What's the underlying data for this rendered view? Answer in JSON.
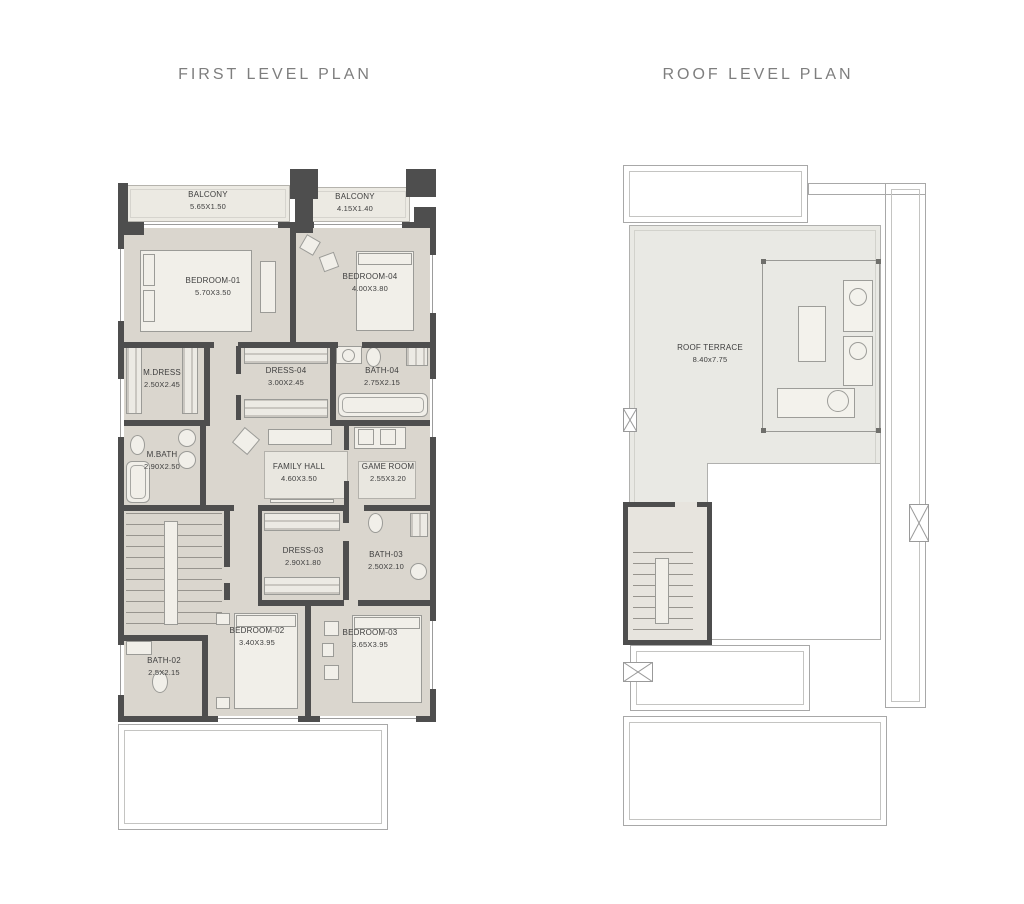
{
  "titles": {
    "first": "FIRST LEVEL PLAN",
    "roof": "ROOF LEVEL PLAN"
  },
  "colors": {
    "wall": "#4e4e4e",
    "floor": "#dad6ce",
    "balcony_floor": "#eceae3",
    "terrace": "#e9e9e4",
    "outline": "#a8a8a8",
    "title_text": "#7e7e7e",
    "label_text": "#3e3e3e"
  },
  "first_level": {
    "rooms": [
      {
        "id": "balcony-1",
        "name": "BALCONY",
        "dims": "5.65X1.50"
      },
      {
        "id": "balcony-2",
        "name": "BALCONY",
        "dims": "4.15X1.40"
      },
      {
        "id": "bedroom-01",
        "name": "BEDROOM-01",
        "dims": "5.70X3.50"
      },
      {
        "id": "bedroom-04",
        "name": "BEDROOM-04",
        "dims": "4.00X3.80"
      },
      {
        "id": "m-dress",
        "name": "M.DRESS",
        "dims": "2.50X2.45"
      },
      {
        "id": "dress-04",
        "name": "DRESS-04",
        "dims": "3.00X2.45"
      },
      {
        "id": "bath-04",
        "name": "BATH-04",
        "dims": "2.75X2.15"
      },
      {
        "id": "m-bath",
        "name": "M.BATH",
        "dims": "2.90X2.50"
      },
      {
        "id": "family-hall",
        "name": "FAMILY HALL",
        "dims": "4.60X3.50"
      },
      {
        "id": "game-room",
        "name": "GAME ROOM",
        "dims": "2.55X3.20"
      },
      {
        "id": "dress-03",
        "name": "DRESS-03",
        "dims": "2.90X1.80"
      },
      {
        "id": "bath-03",
        "name": "BATH-03",
        "dims": "2.50X2.10"
      },
      {
        "id": "bath-02",
        "name": "BATH-02",
        "dims": "2.5X2.15"
      },
      {
        "id": "bedroom-02",
        "name": "BEDROOM-02",
        "dims": "3.40X3.95"
      },
      {
        "id": "bedroom-03",
        "name": "BEDROOM-03",
        "dims": "3.65X3.95"
      }
    ]
  },
  "roof_level": {
    "rooms": [
      {
        "id": "roof-terrace",
        "name": "ROOF TERRACE",
        "dims": "8.40x7.75"
      }
    ]
  }
}
